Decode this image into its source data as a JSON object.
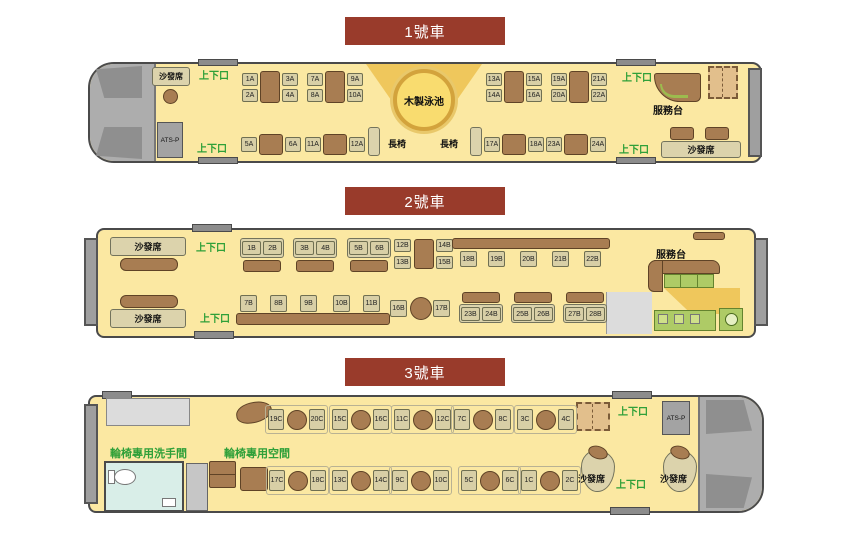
{
  "cars": {
    "car1": {
      "title": "1號車",
      "door_label": "上下口",
      "sofa_label": "沙發席",
      "pool_label": "木製泳池",
      "bench_label": "長椅",
      "service_label": "服務台",
      "atsp_label": "ATS-P",
      "quads": [
        [
          "1A",
          "2A",
          "3A",
          "4A"
        ],
        [
          "7A",
          "8A",
          "9A",
          "10A"
        ],
        [
          "13A",
          "14A",
          "15A",
          "16A"
        ],
        [
          "19A",
          "20A",
          "21A",
          "22A"
        ]
      ],
      "pairs": [
        [
          "5A",
          "6A"
        ],
        [
          "11A",
          "12A"
        ],
        [
          "17A",
          "18A"
        ],
        [
          "23A",
          "24A"
        ]
      ]
    },
    "car2": {
      "title": "2號車",
      "door_label": "上下口",
      "sofa_label": "沙發席",
      "service_label": "服務台",
      "booths_top": [
        [
          "1B",
          "2B"
        ],
        [
          "3B",
          "4B"
        ],
        [
          "5B",
          "6B"
        ]
      ],
      "vpairs": [
        [
          "12B",
          "13B"
        ],
        [
          "14B",
          "15B"
        ]
      ],
      "counter_top": [
        "18B",
        "19B",
        "20B",
        "21B",
        "22B"
      ],
      "counter_bottom": [
        "7B",
        "8B",
        "9B",
        "10B",
        "11B"
      ],
      "pair_mid": [
        "16B",
        "17B"
      ],
      "booths_bottom": [
        [
          "23B",
          "24B"
        ],
        [
          "25B",
          "26B"
        ],
        [
          "27B",
          "28B"
        ]
      ]
    },
    "car3": {
      "title": "3號車",
      "door_label": "上下口",
      "sofa_label": "沙發席",
      "atsp_label": "ATS-P",
      "restroom_label": "輪椅專用洗手間",
      "space_label": "輪椅專用空間",
      "singles_top": [
        [
          "19C",
          "20C"
        ],
        [
          "15C",
          "16C"
        ],
        [
          "11C",
          "12C"
        ],
        [
          "7C",
          "8C"
        ],
        [
          "3C",
          "4C"
        ]
      ],
      "singles_bottom": [
        [
          "17C",
          "18C"
        ],
        [
          "13C",
          "14C"
        ],
        [
          "9C",
          "10C"
        ],
        [
          "5C",
          "6C"
        ],
        [
          "1C",
          "2C"
        ]
      ]
    }
  }
}
